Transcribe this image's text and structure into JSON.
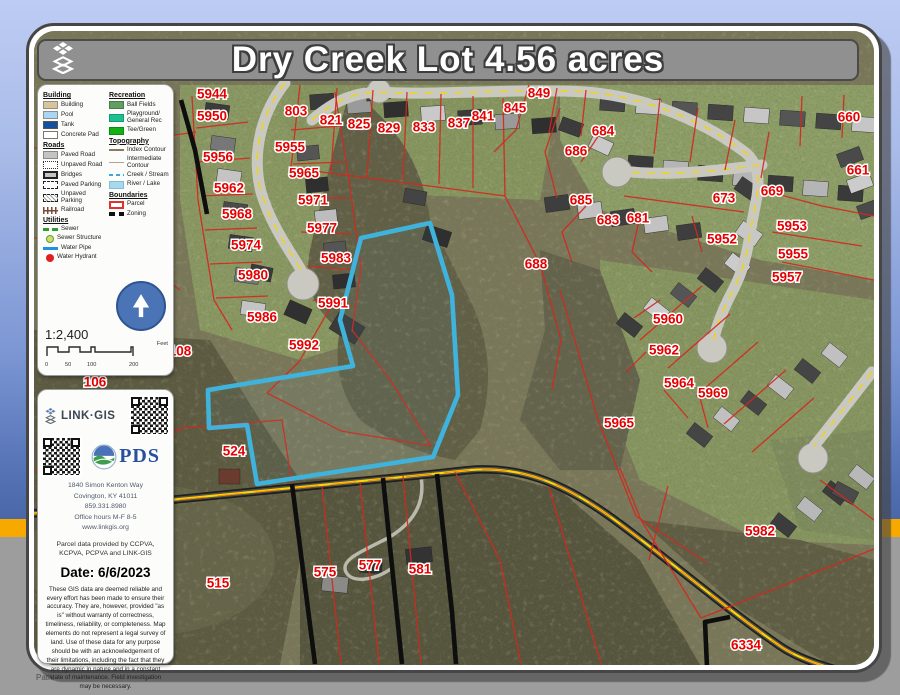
{
  "window": {
    "path_label": "Path:"
  },
  "title": {
    "text": "Dry Creek Lot 4.56 acres"
  },
  "legend": {
    "col1": [
      {
        "title": "Building",
        "items": [
          {
            "label": "Building",
            "swatch": "building"
          },
          {
            "label": "Pool",
            "swatch": "pool"
          },
          {
            "label": "Tank",
            "swatch": "tank"
          },
          {
            "label": "Concrete Pad",
            "swatch": "concrete"
          }
        ]
      },
      {
        "title": "Roads",
        "items": [
          {
            "label": "Paved Road",
            "swatch": "paved-road"
          },
          {
            "label": "Unpaved Road",
            "swatch": "unpaved-road"
          },
          {
            "label": "Bridges",
            "swatch": "bridge"
          },
          {
            "label": "Paved Parking",
            "swatch": "paved-parking"
          },
          {
            "label": "Unpaved Parking",
            "swatch": "unpaved-parking"
          },
          {
            "label": "Railroad",
            "swatch": "railroad"
          }
        ]
      },
      {
        "title": "Utilities",
        "items": [
          {
            "label": "Sewer",
            "swatch": "sewer"
          },
          {
            "label": "Sewer Structure",
            "swatch": "sewer-structure"
          },
          {
            "label": "Water Pipe",
            "swatch": "water-pipe"
          },
          {
            "label": "Water Hydrant",
            "swatch": "water-hydrant"
          }
        ]
      }
    ],
    "col2": [
      {
        "title": "Recreation",
        "items": [
          {
            "label": "Ball Fields",
            "swatch": "ball-fields"
          },
          {
            "label": "Playground/ General Rec",
            "swatch": "playground"
          },
          {
            "label": "Tee/Green",
            "swatch": "tee-green"
          }
        ]
      },
      {
        "title": "Topography",
        "items": [
          {
            "label": "Index Contour",
            "swatch": "index-contour"
          },
          {
            "label": "Intermediate Contour",
            "swatch": "intermediate-contour"
          },
          {
            "label": "Creek / Stream",
            "swatch": "creek"
          },
          {
            "label": "River / Lake",
            "swatch": "river"
          }
        ]
      },
      {
        "title": "Boundaries",
        "items": [
          {
            "label": "Parcel",
            "swatch": "parcel"
          },
          {
            "label": "Zoning",
            "swatch": "zoning"
          }
        ]
      }
    ]
  },
  "scale": {
    "ratio": "1:2,400",
    "ticks": [
      {
        "t": "0",
        "x": 0
      },
      {
        "t": "50",
        "x": 20
      },
      {
        "t": "100",
        "x": 42
      },
      {
        "t": "200",
        "x": 84
      }
    ],
    "unit": "Feet"
  },
  "info": {
    "brand": "LINK·GIS",
    "pds": "PDS",
    "address_lines": [
      "1840 Simon Kenton Way",
      "Covington, KY 41011",
      "859.331.8980",
      "Office hours M-F 8-5",
      "www.linkgis.org"
    ],
    "source": "Parcel data provided by CCPVA, KCPVA, PCPVA and LINK-GIS",
    "date_label": "Date: 6/6/2023",
    "disclaimer": "These GIS data are deemed reliable and every effort has been made to ensure their accuracy. They are, however, provided \"as is\" without warranty of correctness, timeliness, reliability, or completeness.  Map elements do not represent a legal survey of land. Use of these data for any purpose should be with an acknowledgement of their limitations, including the fact that they are dynamic in nature and in a constant state of maintenance. Field investigation may be necessary."
  },
  "map": {
    "colors": {
      "parcel_line": "#d3281e",
      "zoning": "#0e0e0e",
      "highlight": "#3fb3dc",
      "label": "#e60000",
      "road_fill": "#c9c9c2",
      "road_center": "#f0d319",
      "hwy_casing": "#1f1f1f",
      "hwy_inner": "#56554c",
      "hwy_center": "#ffd400",
      "hwy_accent": "#ff8a00",
      "driveway": "#b9b9ac"
    },
    "highlight_parcel": {
      "points": "430,223 361,238 340,320 353,366 208,390 209,428 247,425 257,484 433,457 458,395 452,295"
    },
    "roads_residential": [
      {
        "d": "M285,83 C262,112 251,152 261,192 C271,226 291,252 301,270",
        "bulb": [
          303,
          284,
          16
        ]
      },
      {
        "d": "M312,120 C334,101 354,92 380,92 C432,96 520,88 586,92 C640,96 700,118 746,153 C757,163 760,176 757,196 C754,212 752,222 750,234",
        "bulb": [
          379,
          91,
          12
        ]
      },
      {
        "d": "M632,172 C672,176 722,170 762,165",
        "bulb": [
          617,
          172,
          15
        ]
      },
      {
        "d": "M750,234 C746,262 739,280 730,296 C721,314 715,330 713,344",
        "bulb": [
          712,
          348,
          15
        ]
      },
      {
        "d": "M872,372 C852,398 832,424 814,446",
        "bulb": [
          813,
          458,
          15
        ]
      }
    ],
    "highway": {
      "d": "M28,514 C120,506 300,488 470,470 C520,466 562,482 612,518 C662,554 722,606 780,646 C800,660 830,668 858,676"
    },
    "driveway": {
      "d": "M420,472 C428,505 410,525 388,538 C360,552 340,560 346,572 C352,584 376,580 392,568"
    },
    "zoning_lines": [
      "181,100 195,150 207,214",
      "292,484 315,664",
      "383,478 402,664",
      "437,474 452,612 456,664",
      "730,617 705,622 707,667"
    ],
    "parcel_lines": [
      "34,148 140,140 196,132",
      "86,85 94,180 98,330",
      "192,96 198,200 214,300 232,330",
      "196,128 248,122",
      "198,162 250,158",
      "201,196 253,194",
      "205,230 257,228",
      "210,264 262,262",
      "216,298 268,296",
      "335,92 349,180 361,268 352,332",
      "291,130 339,126",
      "293,164 343,162",
      "297,198 347,198",
      "301,232 351,234",
      "307,266 352,270",
      "313,300 352,306",
      "300,85 291,168",
      "337,88 331,172",
      "373,90 367,176",
      "407,92 403,180",
      "441,94 439,184",
      "473,96 473,188",
      "503,98 505,196",
      "291,168 399,182 505,196",
      "505,196 540,264 561,340 552,390",
      "529,85 516,130 494,152",
      "557,88 549,133",
      "586,90 581,136",
      "560,108 545,152 557,198",
      "601,132 581,162",
      "586,206 562,232 572,262",
      "641,212 632,252 652,272",
      "692,216 702,252",
      "660,98 654,154",
      "698,108 690,162",
      "735,120 725,170",
      "769,132 761,178",
      "624,196 744,212",
      "762,190 822,206 874,216",
      "772,232 862,246",
      "782,262 874,280",
      "800,146 802,96",
      "842,138 844,95",
      "560,290 598,420 636,516",
      "636,516 706,562",
      "640,340 702,286",
      "668,368 730,314",
      "696,396 758,342",
      "724,424 786,370",
      "752,452 814,398",
      "660,300 634,318",
      "646,352 626,372",
      "664,390 688,418",
      "700,398 708,428",
      "182,428 282,420 292,484",
      "34,470 120,462 182,428",
      "34,238 120,246 180,290",
      "322,486 341,664",
      "360,482 379,664",
      "403,476 421,664",
      "455,472 500,560 521,664",
      "549,487 601,664",
      "620,468 641,520 701,618",
      "668,486 649,560",
      "701,618 782,586 874,549",
      "820,480 874,520",
      "330,308 299,362 267,393",
      "267,393 341,431 431,446",
      "352,330 391,381 431,446"
    ],
    "house_groups": [
      {
        "x": 205,
        "y": 104,
        "dx": 6,
        "dy": 33,
        "n": 7,
        "w": 24,
        "h": 14,
        "rot": 8,
        "fills": [
          "#3b3b3b",
          "#777777",
          "#c4c4c4",
          "#4a4a4a"
        ]
      },
      {
        "x": 297,
        "y": 146,
        "dx": 9,
        "dy": 32,
        "n": 5,
        "w": 22,
        "h": 14,
        "rot": -6,
        "fills": [
          "#555555",
          "#2f2f2f",
          "#bdbdbd"
        ]
      },
      {
        "x": 310,
        "y": 94,
        "dx": 37,
        "dy": 4,
        "n": 7,
        "w": 24,
        "h": 15,
        "rot": -4,
        "fills": [
          "#3a3a3a",
          "#9a9a9a",
          "#2f2f2f",
          "#c9c9c9"
        ]
      },
      {
        "x": 600,
        "y": 96,
        "dx": 36,
        "dy": 3,
        "n": 8,
        "w": 25,
        "h": 15,
        "rot": 4,
        "fills": [
          "#444444",
          "#c6c6c6",
          "#555555"
        ]
      },
      {
        "x": 628,
        "y": 156,
        "dx": 35,
        "dy": 5,
        "n": 7,
        "w": 25,
        "h": 15,
        "rot": 4,
        "fills": [
          "#3a3a3a",
          "#b5b5b5"
        ]
      },
      {
        "x": 545,
        "y": 196,
        "dx": 33,
        "dy": 7,
        "n": 5,
        "w": 24,
        "h": 15,
        "rot": -8,
        "fills": [
          "#3e3e3e",
          "#c2c2c2"
        ]
      },
      {
        "x": 618,
        "y": 318,
        "dx": 27,
        "dy": -15,
        "n": 5,
        "w": 23,
        "h": 14,
        "rot": 38,
        "fills": [
          "#3c3c3c",
          "#cccccc",
          "#555555"
        ]
      },
      {
        "x": 688,
        "y": 428,
        "dx": 27,
        "dy": -16,
        "n": 6,
        "w": 23,
        "h": 14,
        "rot": 38,
        "fills": [
          "#454545",
          "#c0c0c0"
        ]
      },
      {
        "x": 772,
        "y": 518,
        "dx": 26,
        "dy": -16,
        "n": 4,
        "w": 23,
        "h": 14,
        "rot": 38,
        "fills": [
          "#3c3c3c",
          "#b8b8b8"
        ]
      },
      {
        "x": 838,
        "y": 150,
        "dx": 10,
        "dy": 26,
        "n": 3,
        "w": 24,
        "h": 14,
        "rot": -20,
        "fills": [
          "#4a4a4a",
          "#cccccc"
        ]
      }
    ],
    "houses_single": [
      [
        250,
        266,
        22,
        14,
        12,
        "#3a3a3a"
      ],
      [
        286,
        304,
        24,
        16,
        24,
        "#303030"
      ],
      [
        332,
        318,
        30,
        20,
        32,
        "#3a3a3a"
      ],
      [
        424,
        228,
        26,
        16,
        18,
        "#2f2f2f"
      ],
      [
        404,
        190,
        22,
        14,
        10,
        "#444444"
      ],
      [
        322,
        576,
        26,
        16,
        6,
        "#8a8a86"
      ],
      [
        360,
        560,
        22,
        13,
        4,
        "#2e2e2e"
      ],
      [
        406,
        548,
        26,
        15,
        -6,
        "#333333"
      ],
      [
        833,
        486,
        24,
        14,
        28,
        "#4a4a4a"
      ],
      [
        219,
        469,
        21,
        15,
        0,
        "#6a3b2e"
      ],
      [
        560,
        120,
        22,
        14,
        20,
        "#3c3c3c"
      ],
      [
        590,
        138,
        22,
        14,
        25,
        "#c9c9c9"
      ],
      [
        366,
        86,
        24,
        14,
        -6,
        "#3f3f3f"
      ],
      [
        736,
        182,
        24,
        15,
        35,
        "#3e3e3e"
      ],
      [
        737,
        226,
        24,
        15,
        35,
        "#c8c8c8"
      ]
    ],
    "parcel_labels": [
      [
        "5944",
        212,
        94
      ],
      [
        "5950",
        212,
        116
      ],
      [
        "803",
        296,
        111
      ],
      [
        "821",
        331,
        120
      ],
      [
        "825",
        359,
        124
      ],
      [
        "829",
        389,
        128
      ],
      [
        "833",
        424,
        127
      ],
      [
        "837",
        459,
        123
      ],
      [
        "841",
        483,
        116
      ],
      [
        "845",
        515,
        108
      ],
      [
        "849",
        539,
        93
      ],
      [
        "5955",
        290,
        147
      ],
      [
        "5956",
        218,
        157
      ],
      [
        "5965",
        304,
        173
      ],
      [
        "5962",
        229,
        188
      ],
      [
        "5971",
        313,
        200
      ],
      [
        "5968",
        237,
        214
      ],
      [
        "5977",
        322,
        228
      ],
      [
        "5974",
        246,
        245
      ],
      [
        "5983",
        336,
        258
      ],
      [
        "5980",
        253,
        275
      ],
      [
        "5991",
        333,
        303
      ],
      [
        "5986",
        262,
        317
      ],
      [
        "5992",
        304,
        345
      ],
      [
        "684",
        603,
        131
      ],
      [
        "686",
        576,
        151
      ],
      [
        "685",
        581,
        200
      ],
      [
        "683",
        608,
        220
      ],
      [
        "681",
        638,
        218
      ],
      [
        "673",
        724,
        198
      ],
      [
        "5952",
        722,
        239
      ],
      [
        "688",
        536,
        264
      ],
      [
        "660",
        849,
        117
      ],
      [
        "661",
        858,
        170
      ],
      [
        "669",
        772,
        191
      ],
      [
        "5953",
        792,
        226
      ],
      [
        "5955",
        793,
        254
      ],
      [
        "5957",
        787,
        277
      ],
      [
        "5960",
        668,
        319
      ],
      [
        "5962",
        664,
        350
      ],
      [
        "5964",
        679,
        383
      ],
      [
        "5969",
        713,
        393
      ],
      [
        "5965",
        619,
        423
      ],
      [
        "108",
        180,
        351
      ],
      [
        "106",
        95,
        382
      ],
      [
        "524",
        234,
        451
      ],
      [
        "515",
        218,
        583
      ],
      [
        "575",
        325,
        572
      ],
      [
        "577",
        370,
        565
      ],
      [
        "581",
        420,
        569
      ],
      [
        "5982",
        760,
        531
      ],
      [
        "6334",
        746,
        645
      ]
    ]
  }
}
